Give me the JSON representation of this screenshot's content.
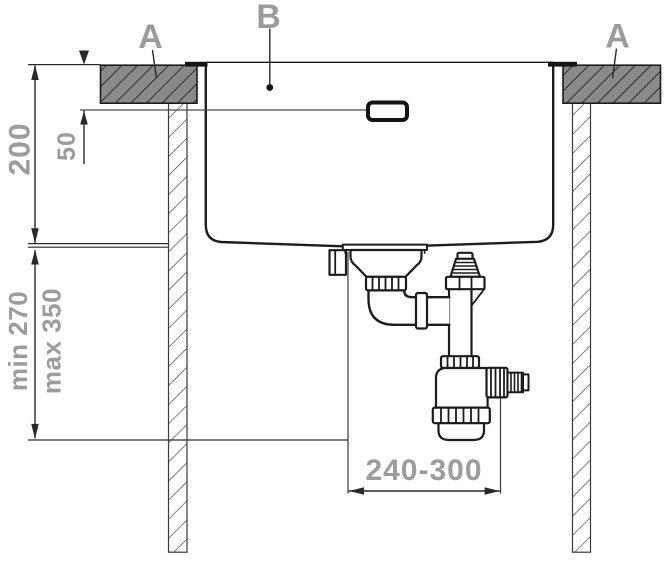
{
  "labels": {
    "a_left": "A",
    "b": "B",
    "a_right": "A"
  },
  "dimensions": {
    "cutout_depth": "200",
    "overflow_offset": "50",
    "min_clearance": "min 270",
    "max_clearance": "max 350",
    "trap_span_range": "240-300"
  },
  "colors": {
    "label_gray": "#9c9c9c",
    "line_black": "#1c1c1c",
    "dim_line": "#2a2a2a",
    "worktop_fill": "#8a8a8a",
    "background": "#ffffff"
  }
}
